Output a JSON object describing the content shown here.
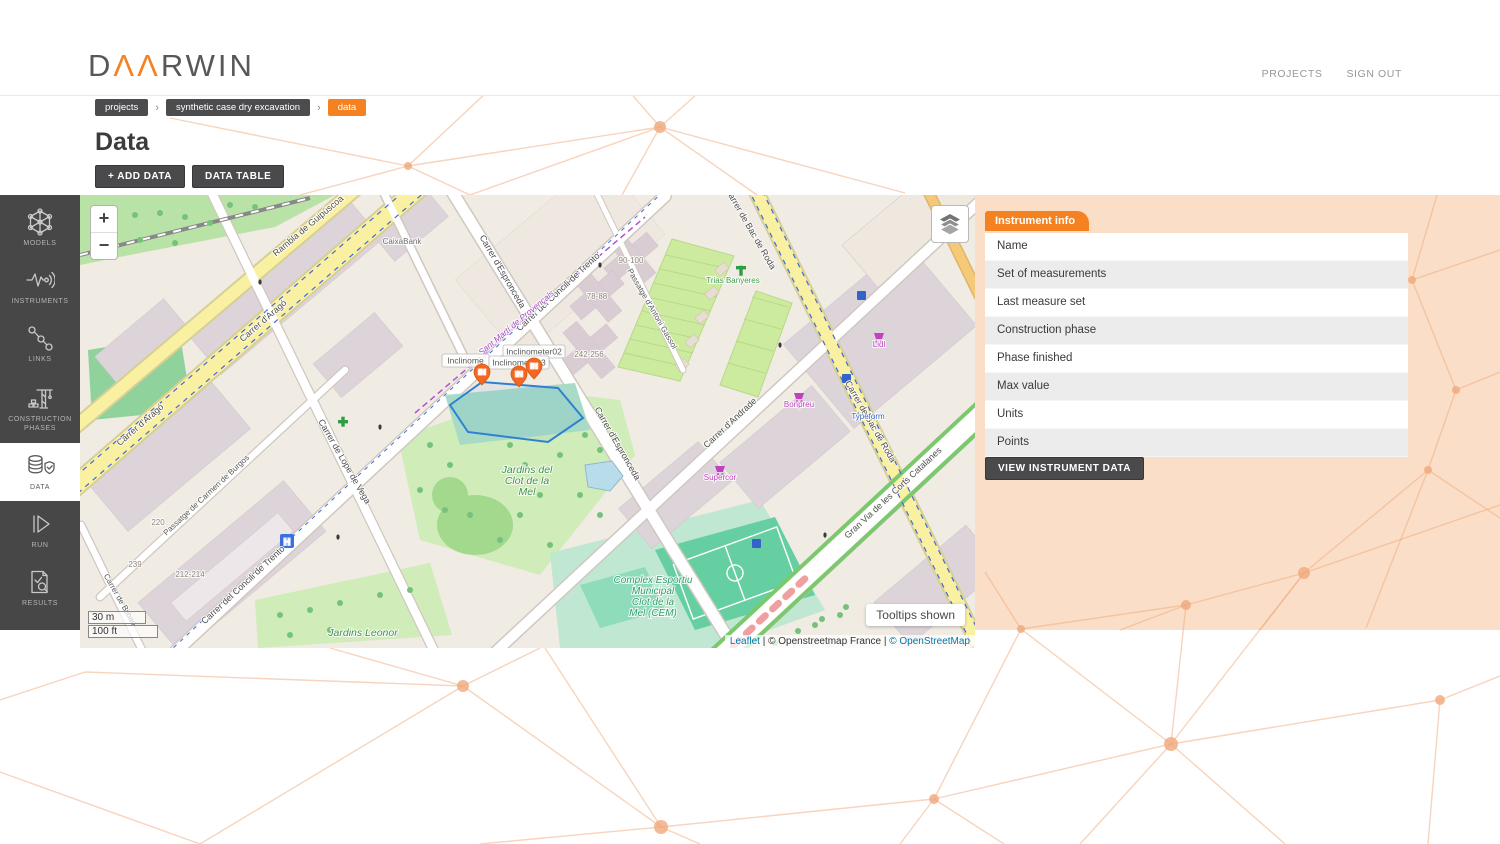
{
  "theme": {
    "accent": "#f58220",
    "panel_bg": "#fbdec7",
    "sidebar_bg": "#474747",
    "marker_orange": "#f26722",
    "excavation_outline": "#2f80d0",
    "mesh_line": "#efa97c"
  },
  "header": {
    "logo": {
      "d": "D",
      "aa": "ΛΛ",
      "rwin": "RWIN"
    },
    "nav": [
      {
        "label": "PROJECTS"
      },
      {
        "label": "SIGN OUT"
      }
    ]
  },
  "breadcrumb": {
    "separator": "›",
    "items": [
      {
        "label": "projects"
      },
      {
        "label": "synthetic case dry excavation"
      },
      {
        "label": "data"
      }
    ]
  },
  "page": {
    "title": "Data",
    "add_data_label": "+ ADD DATA",
    "data_table_label": "DATA TABLE"
  },
  "sidebar": {
    "items": [
      {
        "label": "MODELS"
      },
      {
        "label": "INSTRUMENTS"
      },
      {
        "label": "LINKS"
      },
      {
        "label": "CONSTRUCTION PHASES"
      },
      {
        "label": "DATA"
      },
      {
        "label": "RUN"
      },
      {
        "label": "RESULTS"
      }
    ]
  },
  "instrument_info": {
    "tab_label": "Instrument info",
    "rows": [
      "Name",
      "Set of measurements",
      "Last measure set",
      "Construction phase",
      "Phase finished",
      "Max value",
      "Units",
      "Points"
    ],
    "button_label": "VIEW INSTRUMENT DATA"
  },
  "map": {
    "zoom_in": "+",
    "zoom_out": "−",
    "scale": {
      "metric": "30 m",
      "imperial": "100 ft"
    },
    "tooltips_badge": "Tooltips shown",
    "attribution_parts": [
      {
        "text": "Leaflet",
        "link": true
      },
      {
        "text": " | ",
        "link": false
      },
      {
        "text": "© Openstreetmap France",
        "link": false
      },
      {
        "text": " | ",
        "link": false
      },
      {
        "text": "© OpenStreetMap",
        "link": true
      }
    ],
    "markers": [
      {
        "label": "IN",
        "x": 402,
        "y": 190
      },
      {
        "label": "IN",
        "x": 439,
        "y": 192
      },
      {
        "label": "IN",
        "x": 454,
        "y": 184
      }
    ],
    "tooltips": [
      {
        "text": "Inclinome",
        "x": 362,
        "y": 159,
        "w": 47
      },
      {
        "text": "Inclinometer02",
        "x": 423,
        "y": 150,
        "w": 62
      },
      {
        "text": "Inclinometer 3",
        "x": 409,
        "y": 161,
        "w": 60
      }
    ],
    "labels": [
      {
        "text": "Rambla de Guipúscoa",
        "x": 230,
        "y": 33,
        "r": -40,
        "cls": "road"
      },
      {
        "text": "Carrer d'Aragó",
        "x": 62,
        "y": 232,
        "r": -41,
        "cls": "road"
      },
      {
        "text": "Carrer d'Aragó",
        "x": 185,
        "y": 128,
        "r": -41,
        "cls": "road"
      },
      {
        "text": "Carrer d'Espronceda",
        "x": 420,
        "y": 78,
        "r": 60,
        "cls": "road"
      },
      {
        "text": "Carrer d'Espronceda",
        "x": 535,
        "y": 250,
        "r": 60,
        "cls": "road"
      },
      {
        "text": "Carrer del Concili de Trento",
        "x": 480,
        "y": 99,
        "r": -43,
        "cls": "road"
      },
      {
        "text": "Carrer del Concili de Trento",
        "x": 165,
        "y": 392,
        "r": -43,
        "cls": "road"
      },
      {
        "text": "Passatge de Carmen de Burgos",
        "x": 128,
        "y": 302,
        "r": -43,
        "cls": "road_sm"
      },
      {
        "text": "Carrer de Bilbao",
        "x": 38,
        "y": 406,
        "r": 60,
        "cls": "road_sm"
      },
      {
        "text": "Carrer de Lope de Vega",
        "x": 262,
        "y": 268,
        "r": 60,
        "cls": "road"
      },
      {
        "text": "Carrer de Bac de Roda",
        "x": 668,
        "y": 35,
        "r": 60,
        "cls": "road"
      },
      {
        "text": "Carrer de Bac de Roda",
        "x": 788,
        "y": 228,
        "r": 60,
        "cls": "road"
      },
      {
        "text": "Carrer d'Andrade",
        "x": 652,
        "y": 230,
        "r": -43,
        "cls": "road"
      },
      {
        "text": "Gran Via de les Corts Catalanes",
        "x": 815,
        "y": 300,
        "r": -43,
        "cls": "road"
      },
      {
        "text": "Passatge d'Antoni Gassol",
        "x": 570,
        "y": 115,
        "r": 60,
        "cls": "road_sm"
      },
      {
        "text": "Sant Martí de Provençals",
        "x": 438,
        "y": 130,
        "r": -40,
        "cls": "boundary"
      },
      {
        "lines": [
          "Jardins del",
          "Clot de la",
          "Mel"
        ],
        "x": 447,
        "y": 278,
        "r": 0,
        "cls": "park"
      },
      {
        "text": "Jardins Leonor",
        "x": 283,
        "y": 441,
        "r": 0,
        "cls": "park"
      },
      {
        "lines": [
          "Complex Esportiu",
          "Municipal",
          "Clot de la",
          "Mel (CEM)"
        ],
        "x": 573,
        "y": 388,
        "r": 0,
        "cls": "sports"
      },
      {
        "text": "CaixaBank",
        "x": 322,
        "y": 49,
        "r": 0,
        "cls": "poi_gray"
      },
      {
        "text": "90-100",
        "x": 551,
        "y": 68,
        "r": 0,
        "cls": "housenum"
      },
      {
        "text": "78-88",
        "x": 517,
        "y": 104,
        "r": 0,
        "cls": "housenum"
      },
      {
        "text": "242-256",
        "x": 509,
        "y": 162,
        "r": 0,
        "cls": "housenum"
      },
      {
        "text": "212-214",
        "x": 110,
        "y": 382,
        "r": 0,
        "cls": "housenum"
      },
      {
        "text": "220",
        "x": 78,
        "y": 330,
        "r": 0,
        "cls": "housenum"
      },
      {
        "text": "239",
        "x": 55,
        "y": 372,
        "r": 0,
        "cls": "housenum"
      },
      {
        "text": "Trias Banyeres",
        "x": 653,
        "y": 88,
        "r": 0,
        "cls": "poi_green"
      },
      {
        "text": "Typeform",
        "x": 788,
        "y": 224,
        "r": 0,
        "cls": "poi_blue"
      },
      {
        "text": "Lidl",
        "x": 799,
        "y": 152,
        "r": 0,
        "cls": "poi_mag"
      },
      {
        "text": "Bonpreu",
        "x": 719,
        "y": 212,
        "r": 0,
        "cls": "poi_mag"
      },
      {
        "text": "Supercor",
        "x": 640,
        "y": 285,
        "r": 0,
        "cls": "poi_mag"
      }
    ]
  }
}
